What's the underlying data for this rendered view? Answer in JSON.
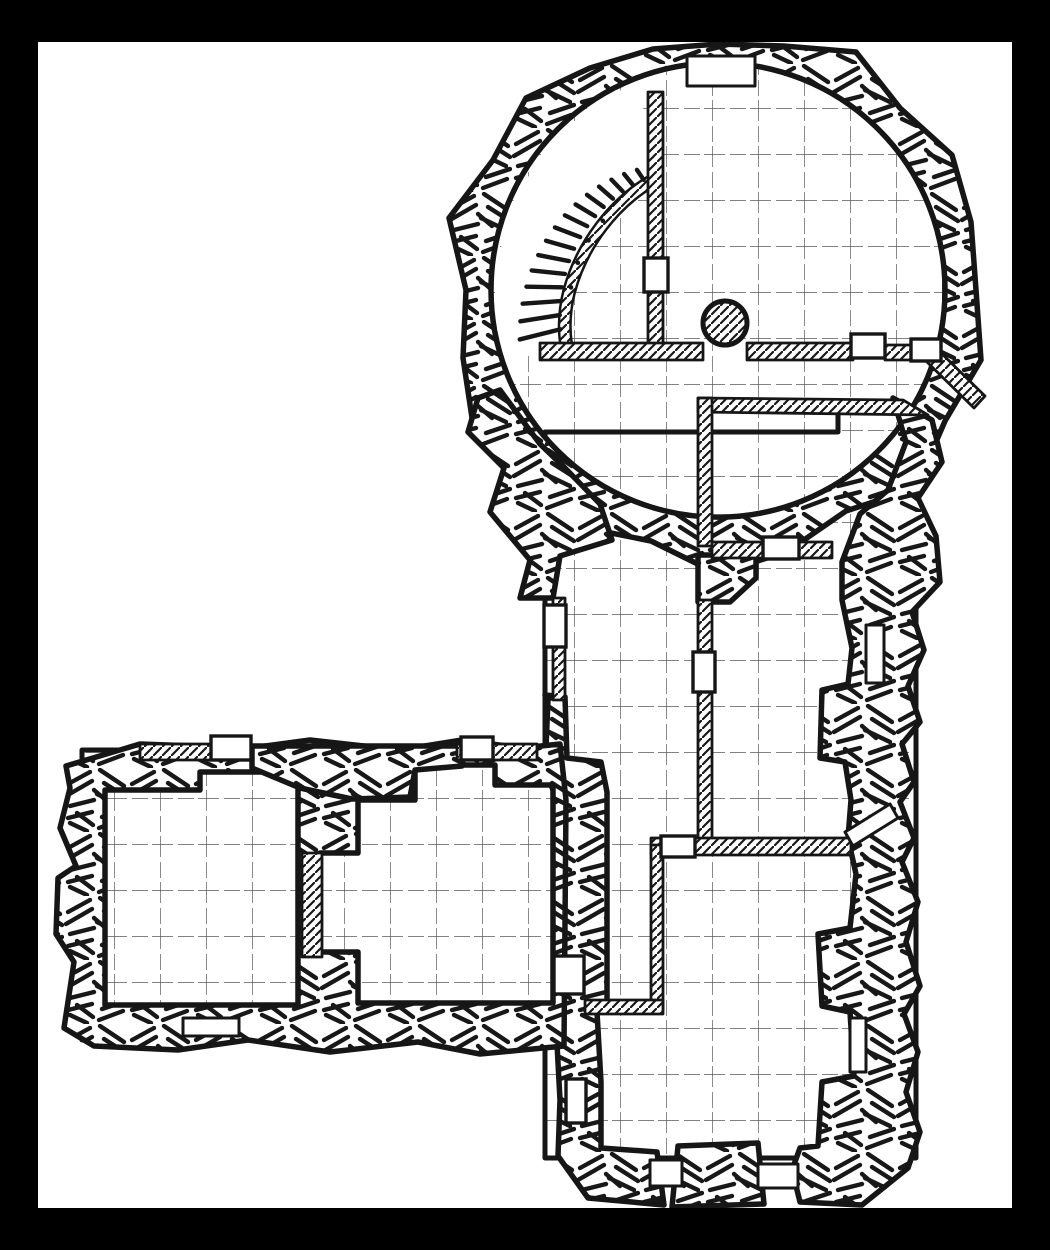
{
  "title": "dungeon-floorplan",
  "colors": {
    "frame": "#000000",
    "paper": "#ffffff",
    "ink": "#161616"
  },
  "canvas": {
    "width": 1050,
    "height": 1250,
    "paper_x": 38,
    "paper_y": 42,
    "paper_w": 974,
    "paper_h": 1166
  },
  "grid": {
    "size": 46,
    "offset_x": 22,
    "offset_y": 16
  },
  "map": {
    "floors": [
      {
        "name": "circular-chamber-floor",
        "shape": "circle",
        "cx": 718,
        "cy": 290,
        "r": 227
      },
      {
        "name": "south-complex-floor",
        "shape": "path",
        "d": "M 545 432 L 838 432 L 838 406 L 916 406 L 916 1158 L 545 1158 Z"
      },
      {
        "name": "west-wing-floor",
        "shape": "path",
        "d": "M 82 750 L 562 750 L 562 1040 L 82 1040 Z"
      }
    ],
    "rubble_walls": [
      {
        "name": "chamber-ring-wall",
        "d": "M 976 290 L 981 360 L 945 421 L 916 488 L 846 511 L 788 551 L 718 574 L 651 541 L 581 527 L 536 472 L 474 431 L 463 358 L 466 290 L 449 218 L 493 160 L 526 98 L 590 68 L 653 49 L 718 44 L 784 46 L 856 52 L 900 108 L 952 155 L 971 222 Z M 945 290 A 227 227 0 1 1 491 290 A 227 227 0 1 1 945 290 Z"
      },
      {
        "name": "east-wall",
        "d": "M 893 398 L 932 420 L 942 462 L 918 498 L 936 536 L 940 582 L 912 612 L 924 650 L 908 686 L 920 722 L 902 744 L 914 782 L 900 802 L 914 838 L 902 862 L 918 902 L 906 942 L 920 986 L 904 1014 L 918 1052 L 906 1092 L 920 1132 L 908 1168 L 862 1205 L 800 1202 L 792 1170 L 800 1148 L 818 1146 L 822 1082 L 854 1076 L 850 1012 L 822 1006 L 818 934 L 850 928 L 856 874 L 848 838 L 851 800 L 845 762 L 820 758 L 822 690 L 848 684 L 852 648 L 842 600 L 842 562 L 860 514 L 888 490 L 906 442 Z"
      },
      {
        "name": "west-corridor-wall",
        "d": "M 478 398 L 500 390 L 528 428 L 540 444 L 565 468 L 600 504 L 612 540 L 560 556 L 553 598 L 520 598 L 530 560 L 490 512 L 504 468 L 468 432 Z"
      },
      {
        "name": "west-junction-wall",
        "d": "M 545 695 L 565 697 L 567 758 L 601 762 L 607 792 L 607 1000 L 597 1012 L 601 1082 L 601 1148 L 657 1152 L 664 1205 L 588 1198 L 558 1156 L 560 1100 L 557 1044 L 557 800 L 545 770 L 548 700 Z"
      },
      {
        "name": "west-wing-wall",
        "d": "M 66 766 L 140 744 L 250 748 L 310 740 L 400 750 L 462 740 L 522 748 L 560 744 L 566 800 L 564 1046 L 480 1054 L 418 1042 L 330 1052 L 248 1040 L 178 1050 L 94 1046 L 64 1028 L 74 962 L 56 934 L 58 878 L 76 866 L 60 828 L 70 788 Z M 105 790 L 200 790 L 200 772 L 298 772 L 298 1005 L 105 1005 Z M 415 765 L 495 765 L 495 785 L 553 785 L 553 1003 L 358 1003 L 358 952 L 320 952 L 320 853 L 358 853 L 358 800 L 415 800 Z"
      },
      {
        "name": "south-wall-chunk",
        "d": "M 678 1146 L 758 1143 L 764 1204 L 672 1207 Z"
      },
      {
        "name": "hall-step-wall",
        "d": "M 698 555 L 756 555 L 756 578 L 730 602 L 698 602 Z"
      },
      {
        "name": "wing-top-wall-chunk",
        "d": "M 252 746 L 462 746 L 462 766 L 415 770 L 410 797 L 352 799 L 300 788 L 252 768 Z"
      }
    ],
    "thin_walls": [
      {
        "name": "chamber-partition-wall",
        "shape": "rect",
        "x": 648,
        "y": 92,
        "w": 15,
        "h": 253
      },
      {
        "name": "chamber-cross-wall-west",
        "shape": "rect",
        "x": 540,
        "y": 343,
        "w": 163,
        "h": 17
      },
      {
        "name": "chamber-cross-wall-mid",
        "shape": "rect",
        "x": 747,
        "y": 343,
        "w": 106,
        "h": 17
      },
      {
        "name": "chamber-cross-wall-east",
        "shape": "rect",
        "x": 885,
        "y": 345,
        "w": 28,
        "h": 15
      },
      {
        "name": "alcove-wall",
        "shape": "path",
        "d": "M 938 350 L 985 396 L 974 408 L 927 362 Z"
      },
      {
        "name": "trapezoid-room-top-wall",
        "shape": "path",
        "d": "M 698 398 L 903 400 L 928 415 L 698 412 Z"
      },
      {
        "name": "trapezoid-room-west-wall",
        "shape": "rect",
        "x": 698,
        "y": 398,
        "w": 14,
        "h": 148
      },
      {
        "name": "trapezoid-room-south-wall",
        "shape": "rect",
        "x": 712,
        "y": 542,
        "w": 120,
        "h": 16
      },
      {
        "name": "hall-partition-wall",
        "shape": "rect",
        "x": 698,
        "y": 600,
        "w": 14,
        "h": 245
      },
      {
        "name": "south-cross-wall",
        "shape": "rect",
        "x": 651,
        "y": 838,
        "w": 200,
        "h": 17
      },
      {
        "name": "closet-east-wall",
        "shape": "rect",
        "x": 651,
        "y": 845,
        "w": 12,
        "h": 165
      },
      {
        "name": "closet-south-wall",
        "shape": "rect",
        "x": 585,
        "y": 1000,
        "w": 78,
        "h": 14
      },
      {
        "name": "wing-top-wall-west",
        "shape": "rect",
        "x": 140,
        "y": 744,
        "w": 76,
        "h": 16
      },
      {
        "name": "wing-top-wall-east",
        "shape": "rect",
        "x": 457,
        "y": 744,
        "w": 80,
        "h": 16
      },
      {
        "name": "wing-divider-wall",
        "shape": "rect",
        "x": 302,
        "y": 853,
        "w": 20,
        "h": 104
      },
      {
        "name": "corridor-west-wall",
        "shape": "rect",
        "x": 553,
        "y": 598,
        "w": 12,
        "h": 102
      }
    ],
    "necks": [
      {
        "name": "thin-wall-gap-top",
        "shape": "rect",
        "x": 687,
        "y": 56,
        "w": 68,
        "h": 30
      },
      {
        "name": "thin-wall-gap-south-west",
        "shape": "rect",
        "x": 650,
        "y": 1160,
        "w": 32,
        "h": 26
      },
      {
        "name": "thin-wall-gap-south-east",
        "shape": "rect",
        "x": 758,
        "y": 1164,
        "w": 40,
        "h": 24
      },
      {
        "name": "thin-wall-gap-wing",
        "shape": "rect",
        "x": 183,
        "y": 1018,
        "w": 56,
        "h": 18
      },
      {
        "name": "thin-wall-gap-east-upper",
        "shape": "rect",
        "x": 866,
        "y": 625,
        "w": 18,
        "h": 58
      },
      {
        "name": "thin-wall-gap-east-mid",
        "shape": "path",
        "d": "M 845 832 L 890 804 L 898 818 L 853 846 Z"
      },
      {
        "name": "thin-wall-gap-east-lower",
        "shape": "rect",
        "x": 850,
        "y": 1018,
        "w": 16,
        "h": 54
      }
    ],
    "doors": [
      {
        "name": "door-chamber-partition",
        "x": 644,
        "y": 258,
        "w": 24,
        "h": 34
      },
      {
        "name": "door-cross-wall-west",
        "x": 851,
        "y": 334,
        "w": 34,
        "h": 24
      },
      {
        "name": "door-cross-wall-east",
        "x": 911,
        "y": 339,
        "w": 30,
        "h": 22
      },
      {
        "name": "door-trapezoid-room",
        "x": 763,
        "y": 537,
        "w": 36,
        "h": 22
      },
      {
        "name": "door-hall-partition",
        "x": 693,
        "y": 652,
        "w": 22,
        "h": 40
      },
      {
        "name": "door-south-cross",
        "x": 661,
        "y": 836,
        "w": 34,
        "h": 21
      },
      {
        "name": "door-closet-west",
        "x": 554,
        "y": 956,
        "w": 30,
        "h": 38
      },
      {
        "name": "door-corridor-west",
        "x": 544,
        "y": 605,
        "w": 22,
        "h": 42
      },
      {
        "name": "door-hall-west",
        "x": 566,
        "y": 1079,
        "w": 20,
        "h": 44
      },
      {
        "name": "door-wing-room-a",
        "x": 211,
        "y": 736,
        "w": 40,
        "h": 24
      },
      {
        "name": "door-wing-room-b",
        "x": 461,
        "y": 737,
        "w": 32,
        "h": 23
      }
    ],
    "pillar": {
      "name": "stone-pillar",
      "cx": 725,
      "cy": 323,
      "r": 22
    },
    "stairs": {
      "name": "spiral-staircase",
      "cx": 718,
      "cy": 290,
      "angle_start": 166,
      "angle_end": 236,
      "count": 15,
      "sector_d": "M 616 90 L 560 132 L 515 195 L 495 270 L 497 329 L 505 359 L 540 348 L 566 346 L 569 292 C 573 263 582 243 592 228 C 606 208 628 190 650 182 L 648 120 L 636 92 Z",
      "band_d": "M 650 182 C 615 203 582 243 569 292 C 564 312 564 330 566 344"
    }
  }
}
